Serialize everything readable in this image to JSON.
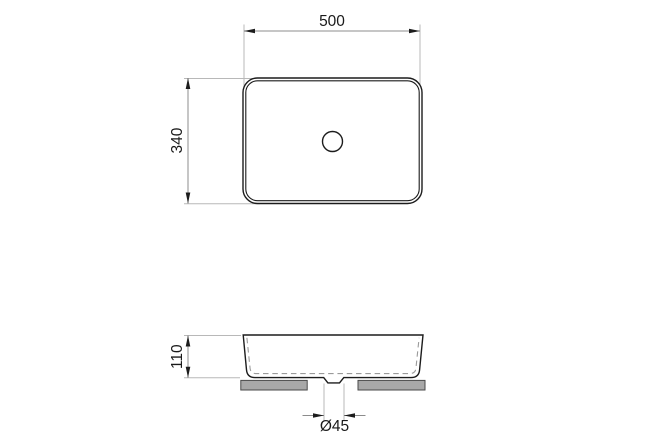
{
  "colors": {
    "background": "#ffffff",
    "object_line": "#1c1c1c",
    "dimension_line": "#8c8c8c",
    "extension_line": "#b8b8b8",
    "hidden_dashed_line": "#9a9a9a",
    "gasket_fill": "#a8a8a8",
    "text": "#1a1a1a"
  },
  "drawing": {
    "dimensions": {
      "width": {
        "value": 500,
        "label": "500"
      },
      "depth": {
        "value": 340,
        "label": "340"
      },
      "height": {
        "value": 110,
        "label": "110"
      },
      "drain": {
        "value": 45,
        "label": "Ø45"
      }
    }
  }
}
